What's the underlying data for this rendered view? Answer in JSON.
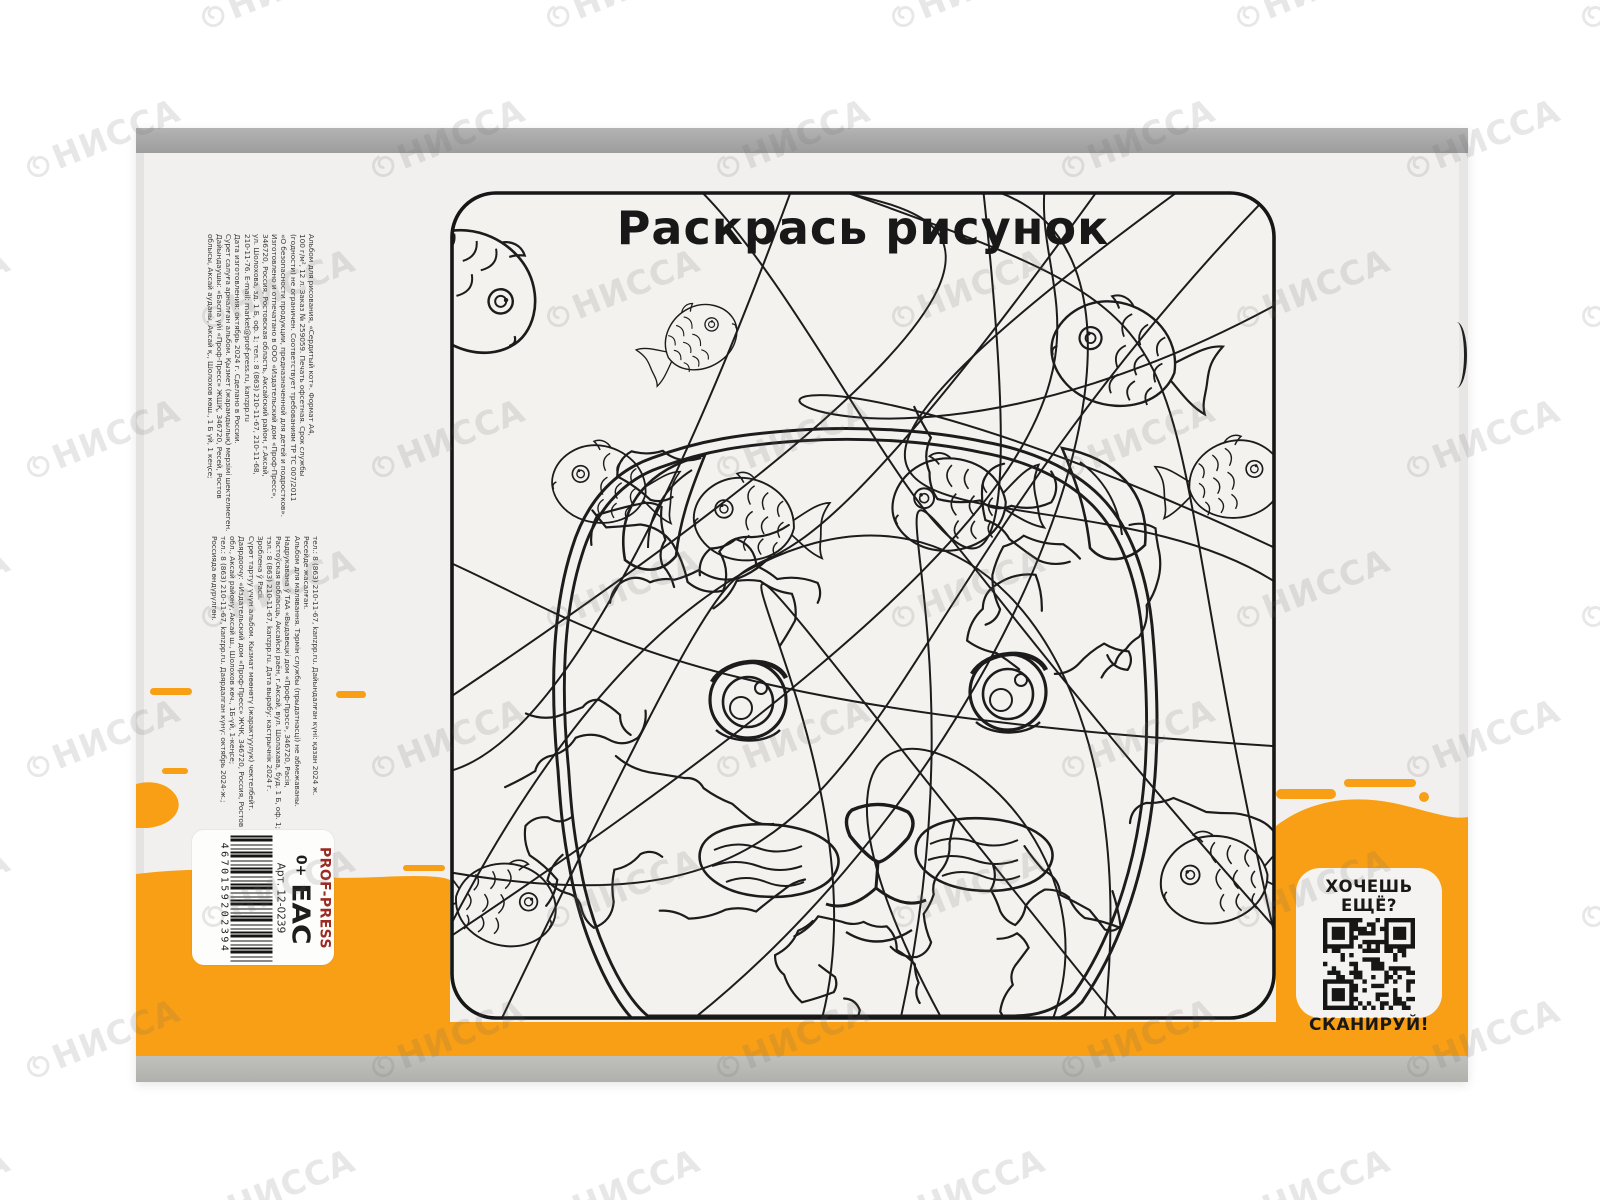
{
  "watermark": {
    "text": "НИССА"
  },
  "page": {
    "title": "Раскрась рисунок"
  },
  "qr_panel": {
    "heading": "ХОЧЕШЬ ЕЩЁ?",
    "caption": "СКАНИРУЙ!"
  },
  "barcode_panel": {
    "brand": "PROF-PRESS",
    "age_rating": "0+",
    "eac_mark": "EAC",
    "article": "Арт. 12-0239",
    "barcode_number": "4670159202394"
  },
  "imprint": {
    "ru_kz_lines": [
      "Альбом для рисования, «Сердитый кот». Формат А4,",
      "100 г/м², 12 л. Заказ № 259059. Печать офсетная. Срок службы",
      "(годности) не ограничен. Соответствует требованиям ТР ТС 007/2011",
      "«О безопасности продукции, предназначенной для детей и подростков».",
      "Изготовлено и отпечатано в ООО «Издательский дом «Проф-Пресс»,",
      "346720, Россия, Ростовская область, Аксайский район, г.Аксай,",
      "ул. Шолохова, зд. 1 Б, оф. 1; тел.: 8 (863) 210-11-67, 210-11-68,",
      "210-11-76. E-mail: market@prof-press.ru, kanzpp.ru",
      "Дата изготовления: октябрь 2024 г. Сделано в России.",
      "Сурет салуға арналған альбом. Қызмет (жарамдылық) мерзімі шектелмеген.",
      "Дайындаушы: «Баспа үйі «Проф-Пресс» ЖШҚ, 346720, Ресей, Ростов",
      "облысы, Аксай ауданы, Аксай қ., Шолохов көш., 1 Б үй, 1 кеңсе;"
    ],
    "be_kg_lines": [
      "тел.: 8 (863) 210-11-67, kanzpp.ru. Дайындалған күні: қазан 2024 ж.",
      "Ресейде жасалған.",
      "Альбом для малявання. Тэрмін службы (прыдатнасці) не абмежаваны.",
      "Надрукавана ў ТАА «Выдавецкі дом «Проф-Прэсс», 346720, Расія,",
      "Растоўская вобласць, Аксайскі раён, г.Аксай, вул. Шолахава, буд. 1 Б, оф. 1;",
      "тэл.: 8 (863) 210-11-67, kanzpp.ru. Дата вырабу: кастрычнік 2024 г.",
      "Зроблена ў Расіі.",
      "Сүрөт тартуу үчүн альбом. Кызмат мөөнөтү (жарактуулук) чектелбейт.",
      "Даярдоочу: «Издательский дом «Проф-Пресс» ЖЧК, 346720, Россия, Ростов",
      "обл., Аксай району, Аксай ш., Шолохов көч., 1Б-үй, 1-кеңсе;",
      "тел.: 8 (863) 210-11-67, kanzpp.ru. Даярдалган күнү: октябрь 2024-ж.;",
      "Россияда өндүрүлгөн."
    ]
  },
  "colors": {
    "accent_orange": "#F89F15",
    "brand_red": "#9B2B22"
  }
}
